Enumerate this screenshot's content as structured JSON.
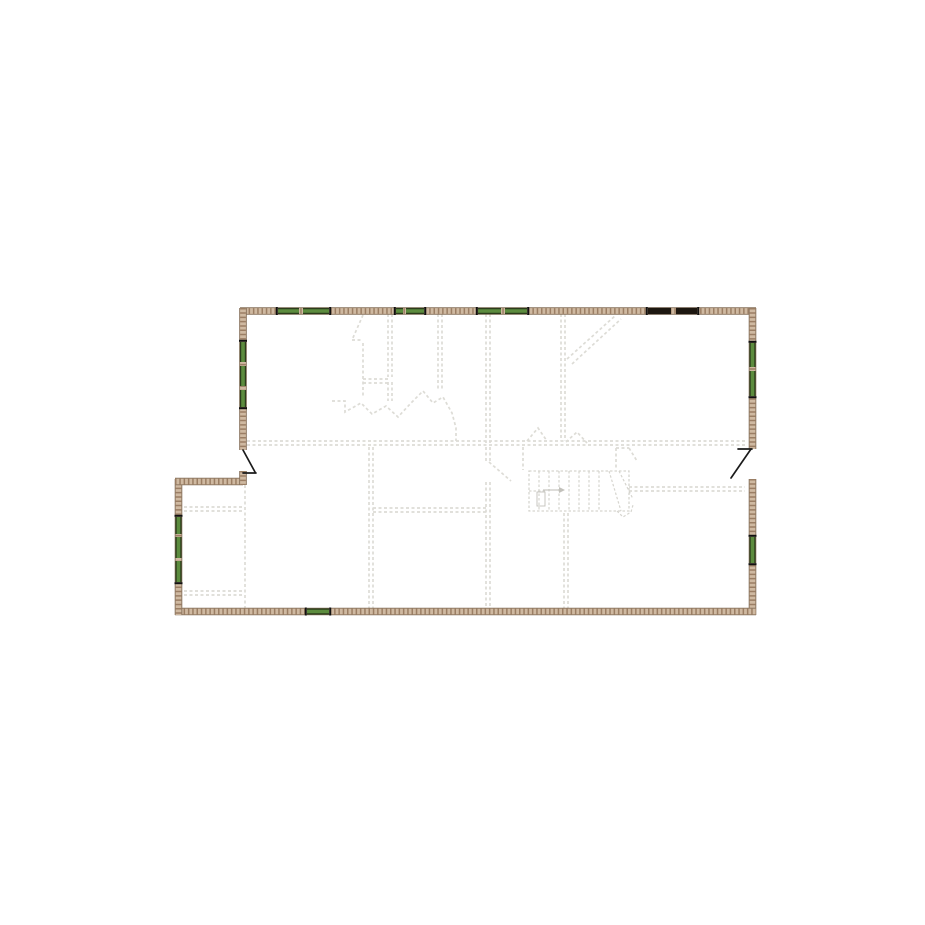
{
  "canvas": {
    "width": 925,
    "height": 925,
    "background": "#ffffff"
  },
  "colors": {
    "wall_edge": "#86705a",
    "wall_fill": "#cfb9a1",
    "wall_dot": "#9b7e64",
    "window_green": "#5c8c3e",
    "window_green_dark": "#2c3c1c",
    "window_dark": "#1d1710",
    "window_cap": "#111111",
    "door_black": "#1b1b1b",
    "interior_dash": "#dddcd6",
    "stair_line": "#d6d5cf",
    "stair_mark": "#c2c1bb"
  },
  "plan": {
    "outer_walls": [
      {
        "name": "wall-top",
        "line": [
          240,
          311,
          756,
          311
        ]
      },
      {
        "name": "wall-right-upper",
        "line": [
          752.5,
          308,
          752.5,
          449
        ]
      },
      {
        "name": "wall-right-lower",
        "line": [
          752.5,
          479,
          752.5,
          615
        ]
      },
      {
        "name": "wall-bottom",
        "line": [
          175,
          611.5,
          756,
          611.5
        ]
      },
      {
        "name": "wall-bump-left",
        "line": [
          178.5,
          479,
          178.5,
          615
        ]
      },
      {
        "name": "wall-bump-top",
        "line": [
          175,
          481.5,
          243,
          481.5
        ]
      },
      {
        "name": "wall-main-left",
        "line": [
          243,
          308,
          243,
          450
        ]
      },
      {
        "name": "wall-left-door-stub",
        "line": [
          243,
          471,
          243,
          485
        ]
      }
    ],
    "windows": [
      {
        "name": "window-top-1",
        "orientation": "h",
        "pos": 311,
        "color": "green",
        "segments": [
          [
            278,
            299
          ],
          [
            303,
            329
          ]
        ]
      },
      {
        "name": "window-top-2",
        "orientation": "h",
        "pos": 311,
        "color": "green",
        "segments": [
          [
            396,
            403
          ],
          [
            406,
            424
          ]
        ]
      },
      {
        "name": "window-top-3",
        "orientation": "h",
        "pos": 311,
        "color": "green",
        "segments": [
          [
            478,
            501
          ],
          [
            505,
            527
          ]
        ]
      },
      {
        "name": "window-top-dark",
        "orientation": "h",
        "pos": 311,
        "color": "dark",
        "segments": [
          [
            648,
            671
          ],
          [
            676,
            697
          ]
        ]
      },
      {
        "name": "window-right-1",
        "orientation": "v",
        "pos": 752.5,
        "color": "green",
        "segments": [
          [
            343,
            367
          ],
          [
            371,
            396
          ]
        ]
      },
      {
        "name": "window-right-2",
        "orientation": "v",
        "pos": 752.5,
        "color": "green",
        "segments": [
          [
            537,
            563
          ]
        ]
      },
      {
        "name": "window-left-1",
        "orientation": "v",
        "pos": 243,
        "color": "green",
        "segments": [
          [
            342,
            362
          ],
          [
            366,
            386
          ],
          [
            390,
            407
          ]
        ]
      },
      {
        "name": "window-bump-1",
        "orientation": "v",
        "pos": 178.5,
        "color": "green",
        "segments": [
          [
            517,
            534
          ],
          [
            537,
            558
          ],
          [
            561,
            582
          ]
        ]
      },
      {
        "name": "window-bottom-1",
        "orientation": "h",
        "pos": 611.5,
        "color": "green",
        "segments": [
          [
            307,
            329
          ]
        ]
      }
    ],
    "doors": [
      {
        "name": "door-left",
        "lines": [
          [
            243,
            450,
            255,
            472
          ],
          [
            243,
            473,
            256,
            473
          ]
        ]
      },
      {
        "name": "door-right",
        "lines": [
          [
            751,
            449,
            731,
            478
          ],
          [
            738,
            449,
            752,
            449
          ]
        ]
      }
    ],
    "interior_walls": [
      [
        388,
        314,
        388,
        377
      ],
      [
        392,
        314,
        392,
        377
      ],
      [
        388,
        382,
        388,
        401
      ],
      [
        392,
        382,
        392,
        401
      ],
      [
        363,
        343,
        363,
        398
      ],
      [
        352,
        340,
        363,
        340
      ],
      [
        363,
        379,
        388,
        379
      ],
      [
        363,
        383,
        388,
        383
      ],
      [
        438,
        314,
        438,
        390
      ],
      [
        442,
        314,
        442,
        390
      ],
      [
        486,
        314,
        486,
        443
      ],
      [
        490,
        314,
        490,
        443
      ],
      [
        561,
        314,
        561,
        441
      ],
      [
        565,
        314,
        565,
        441
      ],
      [
        247,
        441,
        745,
        441
      ],
      [
        247,
        445,
        745,
        445
      ],
      [
        369,
        447,
        369,
        610
      ],
      [
        373,
        447,
        373,
        610
      ],
      [
        486,
        447,
        486,
        461
      ],
      [
        490,
        447,
        490,
        461
      ],
      [
        486,
        482,
        486,
        610
      ],
      [
        490,
        482,
        490,
        610
      ],
      [
        373,
        508,
        486,
        508
      ],
      [
        373,
        512,
        486,
        512
      ],
      [
        629,
        487,
        745,
        487
      ],
      [
        629,
        491,
        745,
        491
      ],
      [
        564,
        513,
        564,
        610
      ],
      [
        568,
        513,
        568,
        610
      ],
      [
        245,
        485,
        245,
        610
      ],
      [
        184,
        507,
        243,
        507
      ],
      [
        184,
        511,
        243,
        511
      ],
      [
        184,
        591,
        243,
        591
      ],
      [
        184,
        595,
        243,
        595
      ],
      [
        523,
        447,
        523,
        470
      ],
      [
        616,
        448,
        616,
        470
      ],
      [
        616,
        448,
        629,
        448
      ]
    ],
    "interior_polylines": [
      {
        "name": "door-swing-upper-left",
        "points": [
          [
            363,
            315
          ],
          [
            352,
            340
          ]
        ]
      },
      {
        "name": "attic-line-a",
        "points": [
          [
            567,
            359
          ],
          [
            616,
            315
          ]
        ]
      },
      {
        "name": "attic-line-b",
        "points": [
          [
            572,
            364
          ],
          [
            621,
            319
          ]
        ]
      },
      {
        "name": "stairwell-outline",
        "points": [
          [
            332,
            401
          ],
          [
            345,
            401
          ],
          [
            345,
            412
          ],
          [
            361,
            403
          ],
          [
            372,
            414
          ],
          [
            386,
            406
          ],
          [
            398,
            417
          ],
          [
            411,
            403
          ],
          [
            423,
            391
          ],
          [
            433,
            403
          ],
          [
            443,
            397
          ],
          [
            452,
            413
          ],
          [
            456,
            428
          ],
          [
            456,
            441
          ]
        ]
      },
      {
        "name": "door-swing-hall-left",
        "points": [
          [
            527,
            441
          ],
          [
            538,
            428
          ],
          [
            547,
            441
          ]
        ]
      },
      {
        "name": "door-swing-hall-right",
        "points": [
          [
            566,
            442
          ],
          [
            577,
            432
          ],
          [
            587,
            443
          ]
        ]
      },
      {
        "name": "door-swing-bedroom",
        "points": [
          [
            489,
            462
          ],
          [
            511,
            481
          ]
        ]
      },
      {
        "name": "winder-corner",
        "points": [
          [
            629,
            448
          ],
          [
            637,
            461
          ]
        ]
      }
    ],
    "stair": {
      "box": [
        529,
        471,
        629,
        511
      ],
      "treads_x": [
        539,
        549,
        559,
        569,
        579,
        589,
        599
      ],
      "winders": [
        [
          609,
          471,
          621,
          511
        ],
        [
          619,
          471,
          633,
          499
        ]
      ],
      "end_cap": [
        [
          617,
          511
        ],
        [
          623,
          517
        ],
        [
          631,
          512
        ],
        [
          633,
          505
        ]
      ],
      "divider": [
        529,
        491,
        546,
        491
      ],
      "arrow": {
        "line": [
          543,
          490,
          559,
          490
        ],
        "head": [
          [
            559,
            487
          ],
          [
            565,
            490
          ],
          [
            559,
            493
          ]
        ],
        "box": [
          537,
          492,
          8,
          14
        ]
      }
    }
  }
}
